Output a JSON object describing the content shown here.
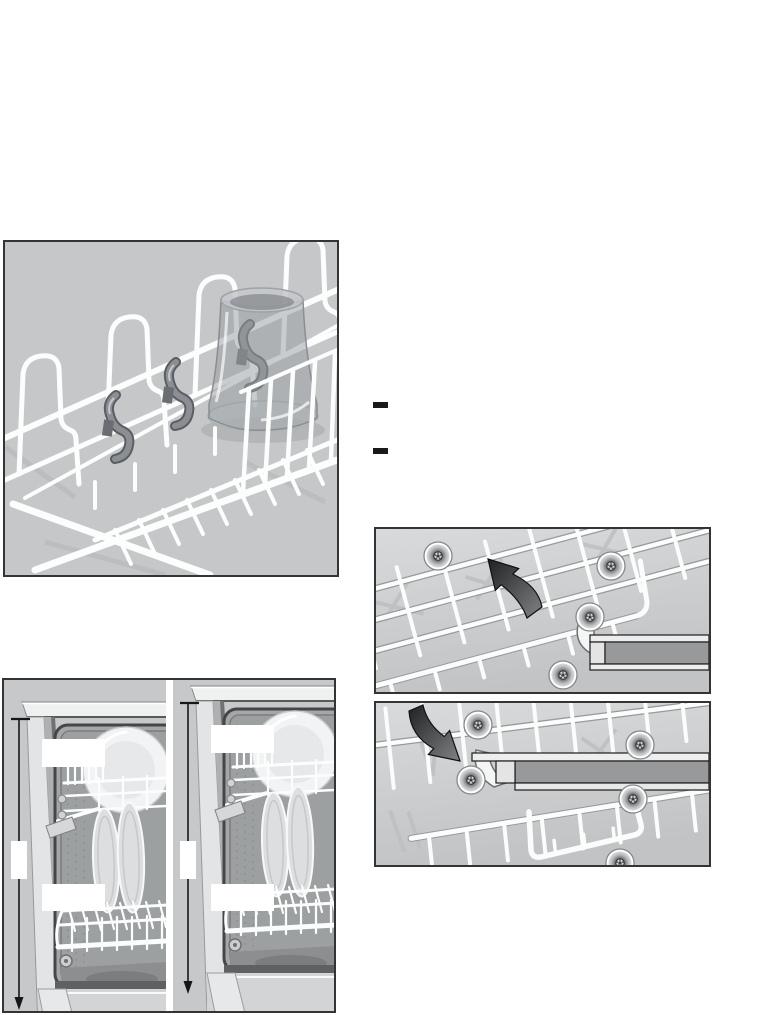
{
  "palette": {
    "page_background": "#ffffff",
    "figure_background": "#c7c8ca",
    "figure_border": "#333436",
    "wire_white": "#fcfdfd",
    "shadow_gray": "#bcbec0",
    "hook_gray": "#7e8286",
    "arrow_dark": "#2f3133",
    "rail_dark": "#98999b",
    "rail_light": "#ededee",
    "bullet_black": "#191919",
    "cavity_gray": "#a4a6a7",
    "dimension_line": "#161616",
    "callout_white": "#ffffff"
  },
  "list": {
    "bullets": [
      "–",
      "–"
    ]
  },
  "figures": {
    "height_comparison": {
      "labels": {
        "left_upper": "",
        "left_lower": "",
        "left_side": "",
        "right_upper": "",
        "right_lower": "",
        "right_side": ""
      }
    }
  }
}
